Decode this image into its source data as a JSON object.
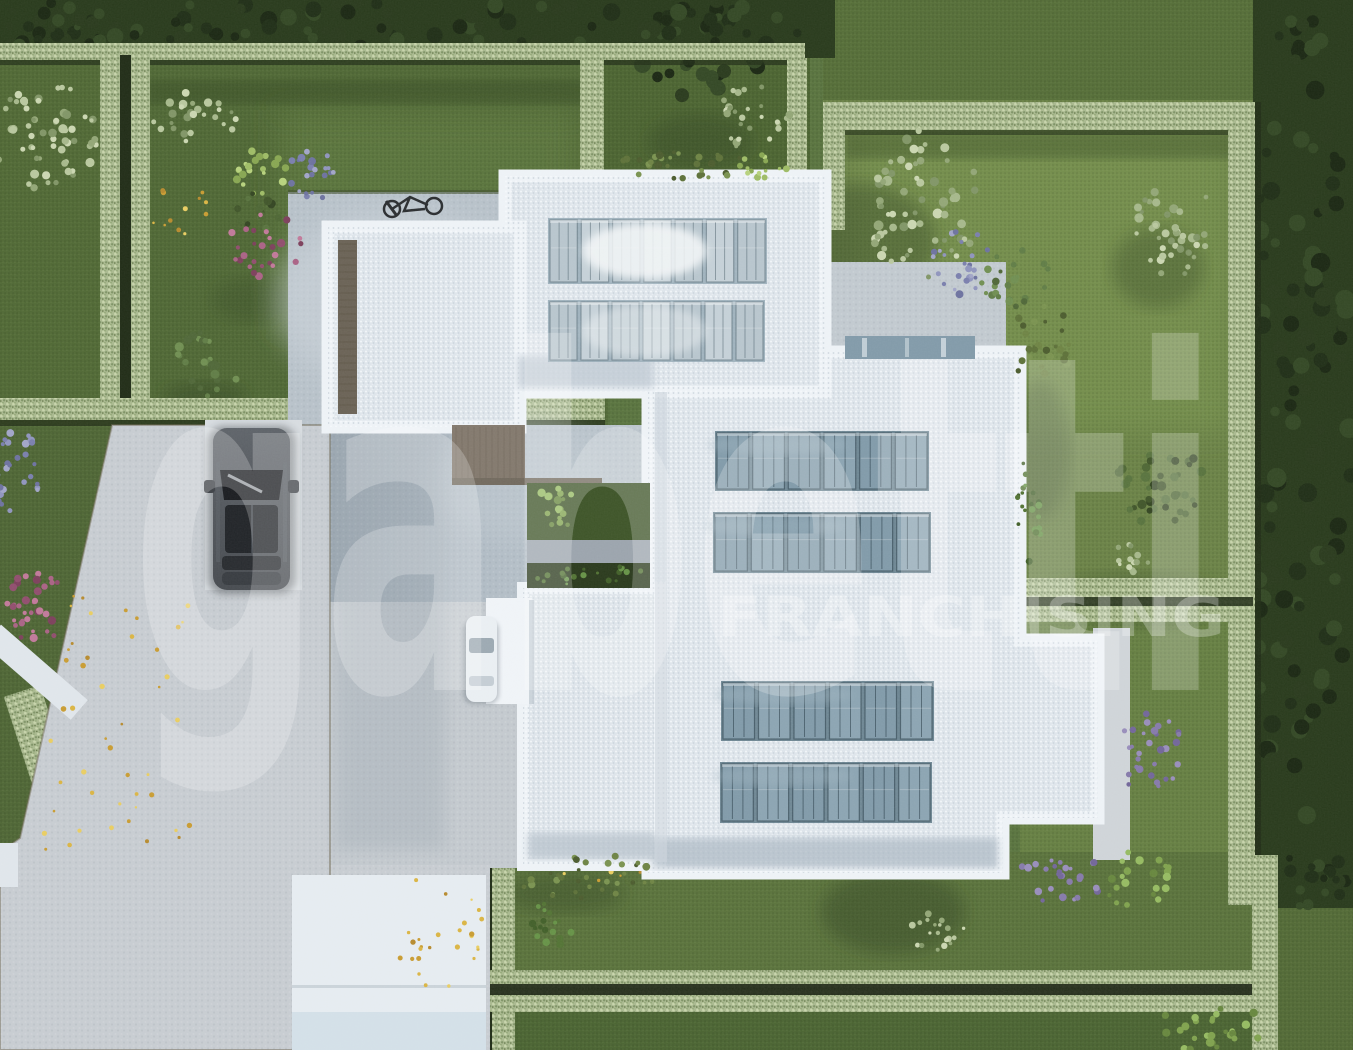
{
  "watermark": {
    "brand": "gabetti",
    "subtitle": "FRANCHISING",
    "color": "#ffffff"
  },
  "palette": {
    "lawn": "#55703a",
    "lawn_dark": "#47602e",
    "lawn_bright": "#66813f",
    "hedge": "#a7b78c",
    "trees": "#243617",
    "driveway": "#c6cbd0",
    "terrace": "#b6c0c8",
    "roof_gravel": "#dde4ea",
    "parapet": "#edf2f6",
    "solar_panel": "#7e98a7",
    "solar_panel_light": "#b5c3cb",
    "car_dark": "#43474c",
    "car_white": "#e9eef2",
    "autumn_leaves": "#d9b340"
  }
}
